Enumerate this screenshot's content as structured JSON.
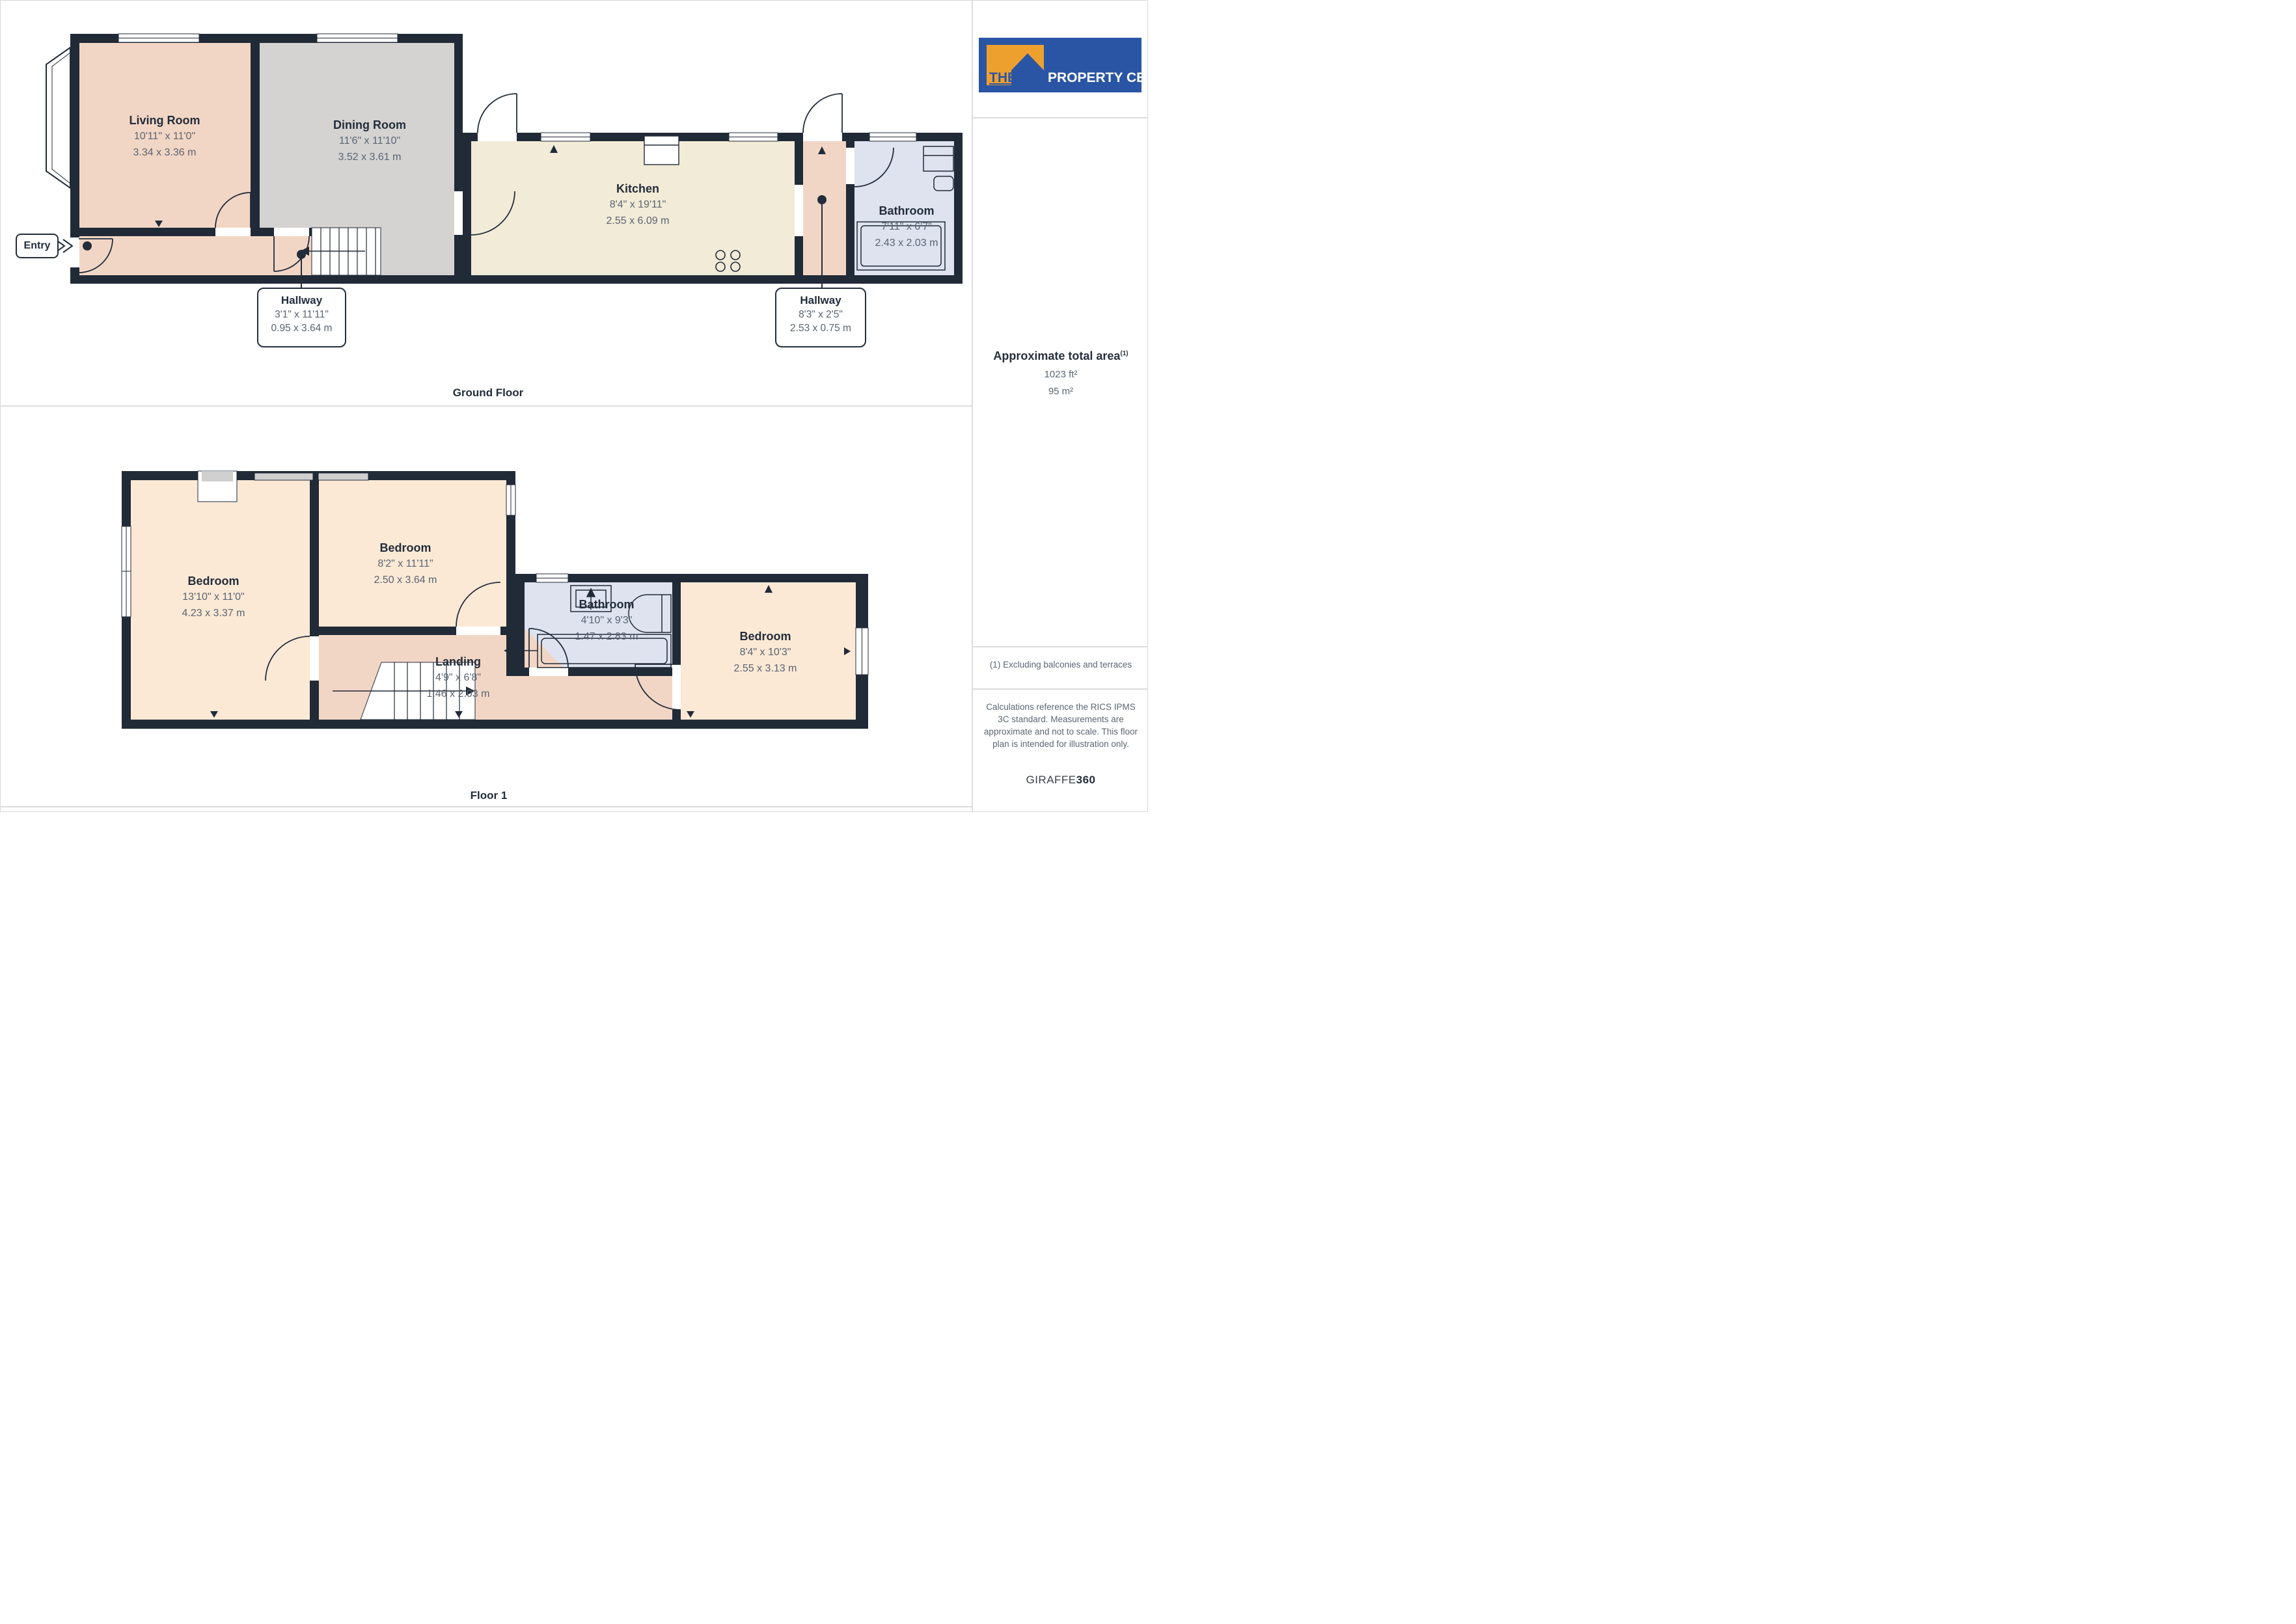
{
  "branding": {
    "logo_the": "THE",
    "logo_rest": "PROPERTY CENTRE",
    "brand_blue": "#2A55A4",
    "brand_orange": "#EEA02F"
  },
  "sidebar": {
    "area_title": "Approximate total area",
    "area_sup": "(1)",
    "area_ft": "1023 ft²",
    "area_m": "95 m²",
    "note1": "(1) Excluding balconies and terraces",
    "note2": "Calculations reference the RICS IPMS 3C standard. Measurements are approximate and not to scale. This floor plan is intended for illustration only.",
    "credit_name": "GIRAFFE",
    "credit_suffix": "360"
  },
  "floors": [
    {
      "label": "Ground Floor",
      "rooms": {
        "living": {
          "name": "Living Room",
          "dims_ft": "10'11\" x 11'0\"",
          "dims_m": "3.34 x 3.36 m"
        },
        "dining": {
          "name": "Dining Room",
          "dims_ft": "11'6\" x 11'10\"",
          "dims_m": "3.52 x 3.61 m"
        },
        "kitchen": {
          "name": "Kitchen",
          "dims_ft": "8'4\" x 19'11\"",
          "dims_m": "2.55 x 6.09 m"
        },
        "bathroom": {
          "name": "Bathroom",
          "dims_ft": "7'11\" x 6'7\"",
          "dims_m": "2.43 x 2.03 m"
        }
      },
      "callouts": {
        "hallway1": {
          "name": "Hallway",
          "dims_ft": "3'1\" x 11'11\"",
          "dims_m": "0.95 x 3.64 m"
        },
        "hallway2": {
          "name": "Hallway",
          "dims_ft": "8'3\" x 2'5\"",
          "dims_m": "2.53 x 0.75 m"
        },
        "entry": {
          "label": "Entry"
        }
      }
    },
    {
      "label": "Floor 1",
      "rooms": {
        "bedroom1": {
          "name": "Bedroom",
          "dims_ft": "13'10\" x 11'0\"",
          "dims_m": "4.23 x 3.37 m"
        },
        "bedroom2": {
          "name": "Bedroom",
          "dims_ft": "8'2\" x 11'11\"",
          "dims_m": "2.50 x 3.64 m"
        },
        "bathroom": {
          "name": "Bathroom",
          "dims_ft": "4'10\" x 9'3\"",
          "dims_m": "1.47 x 2.83 m"
        },
        "bedroom3": {
          "name": "Bedroom",
          "dims_ft": "8'4\" x 10'3\"",
          "dims_m": "2.55 x 3.13 m"
        },
        "landing": {
          "name": "Landing",
          "dims_ft": "4'9\" x 6'8\"",
          "dims_m": "1.46 x 2.03 m"
        }
      }
    }
  ],
  "colors": {
    "wall": "#212A37",
    "room_peach": "#F2D6C5",
    "room_peach_light": "#FBE9D6",
    "room_gray": "#D4D3D2",
    "room_cream": "#F1EBD7",
    "room_blue": "#DEE3EF",
    "text_dark": "#232D3B",
    "text_dim": "#5A6470",
    "divider": "#DCDCDC"
  }
}
